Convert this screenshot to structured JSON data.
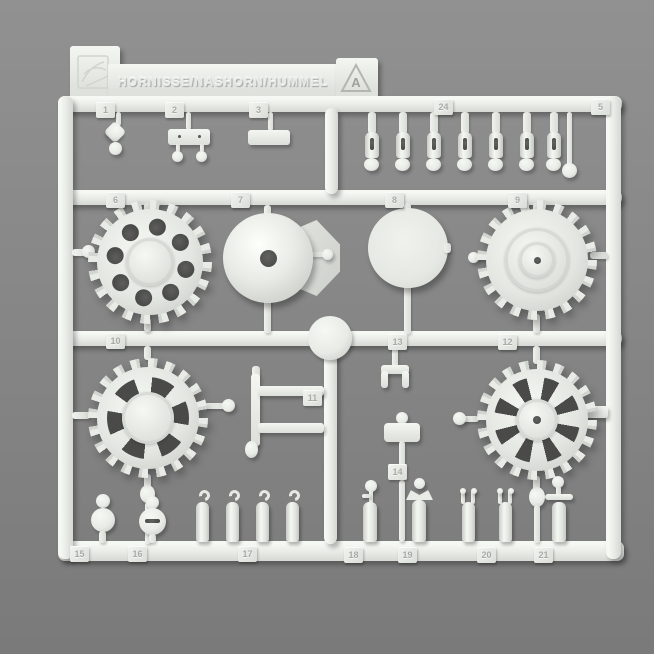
{
  "colors": {
    "background_top": "#919191",
    "background_bottom": "#7a7a7a",
    "plastic": "#e9ebe7",
    "plastic_highlight": "#f6f8f4",
    "hole_dark": "#454543"
  },
  "sprue": {
    "title": "HORNISSE/NASHORN/HUMMEL",
    "letter": "A",
    "tags": {
      "t1": "1",
      "t2": "2",
      "t3": "3",
      "t24": "24",
      "t5": "5",
      "t6": "6",
      "t7": "7",
      "t8": "8",
      "t9": "9",
      "t10": "10",
      "t11": "11",
      "t12": "12",
      "t13": "13",
      "t14": "14",
      "t15": "15",
      "t16": "16",
      "t17": "17",
      "t18": "18",
      "t19": "19",
      "t20": "20",
      "t21": "21"
    }
  },
  "icons": {
    "brand_logo": "dragon-crest-emboss",
    "letter_badge": "triangle-outline"
  }
}
